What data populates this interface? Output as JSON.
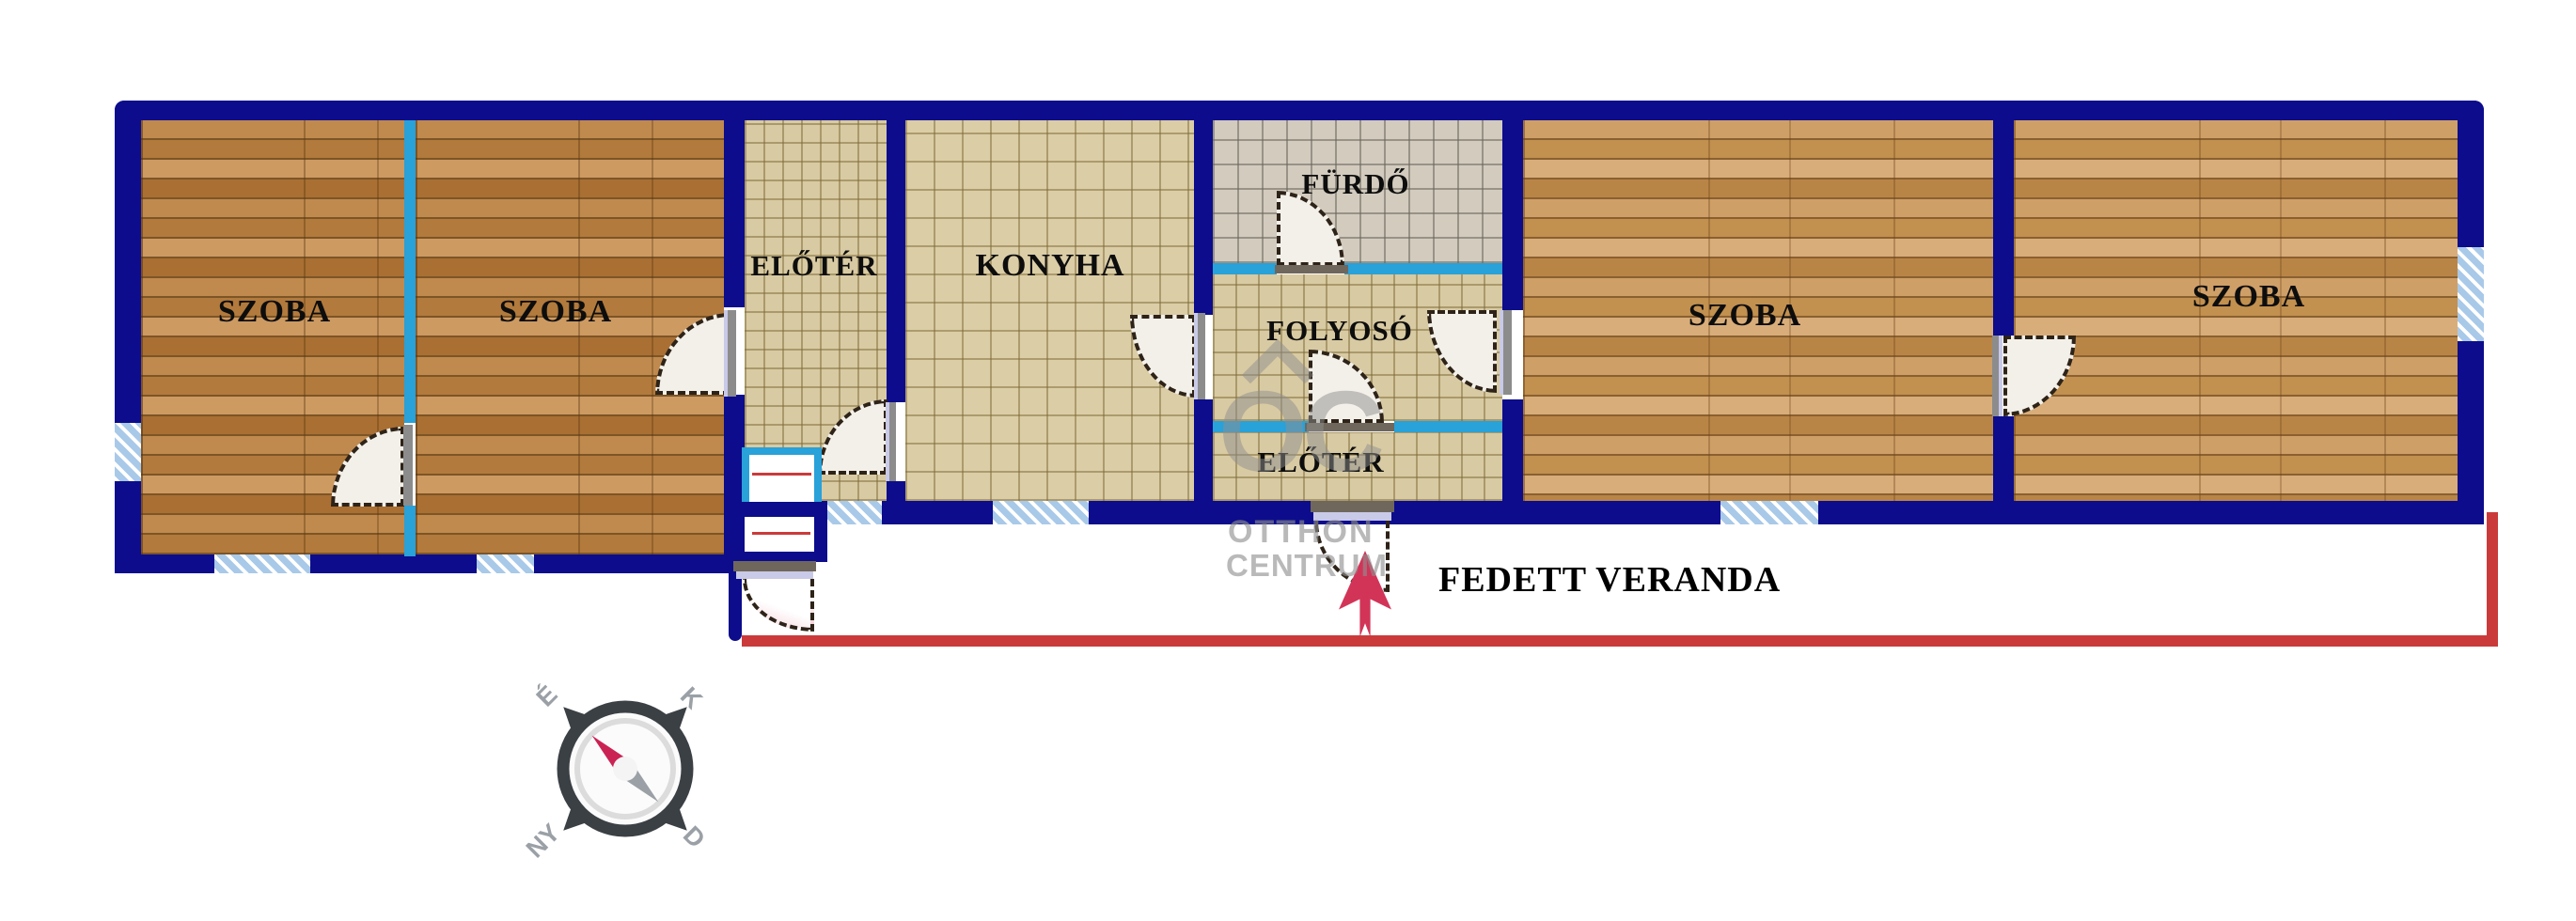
{
  "floorplan": {
    "rooms": {
      "szoba1": {
        "label": "SZOBA"
      },
      "szoba2": {
        "label": "SZOBA"
      },
      "eloter1": {
        "label": "ELŐTÉR"
      },
      "konyha": {
        "label": "KONYHA"
      },
      "furdo": {
        "label": "FÜRDŐ"
      },
      "folyoso": {
        "label": "FOLYOSÓ"
      },
      "eloter2": {
        "label": "ELŐTÉR"
      },
      "szoba3": {
        "label": "SZOBA"
      },
      "szoba4": {
        "label": "SZOBA"
      },
      "veranda": {
        "label": "FEDETT VERANDA"
      }
    },
    "compass": {
      "north": "É",
      "east": "K",
      "south": "D",
      "west": "NY"
    },
    "watermark": {
      "monogram": "OC",
      "line1": "OTTHON",
      "line2": "CENTRUM"
    },
    "colors": {
      "wall": "#0c0c8c",
      "cyan": "#29a1d9",
      "red": "#cb3a3a",
      "arrow": "#d23458",
      "wmark": "#8f8f8f"
    }
  }
}
